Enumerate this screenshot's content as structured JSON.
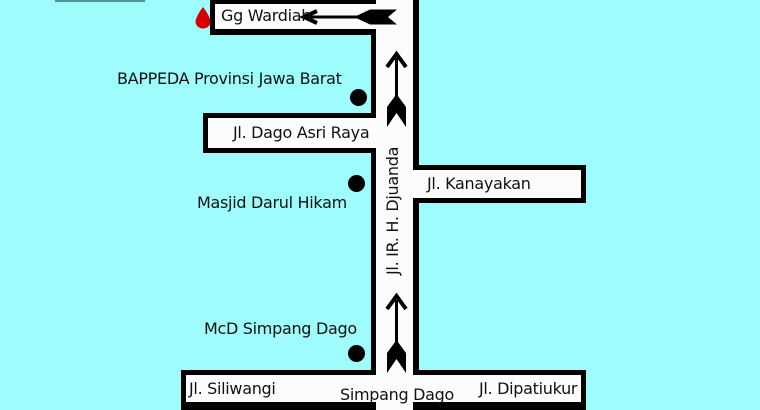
{
  "map": {
    "background_color": "#9ffcfc",
    "road_color": "#fcfcfc",
    "outline_color": "#000000",
    "destination_marker_color": "#d90000",
    "poi_dot_color": "#000000",
    "roads": {
      "djuanda": {
        "label": "Jl. IR. H. Djuanda",
        "orientation": "vertical"
      },
      "gg_wardiah": {
        "label": "Gg Wardiah",
        "orientation": "horizontal"
      },
      "dago_asri": {
        "label": "Jl. Dago Asri Raya",
        "orientation": "horizontal"
      },
      "kanayakan": {
        "label": "Jl. Kanayakan",
        "orientation": "horizontal"
      },
      "siliwangi": {
        "label": "Jl. Siliwangi",
        "orientation": "horizontal"
      },
      "simpang_dago": {
        "label": "Simpang Dago",
        "orientation": "horizontal"
      },
      "dipatiukur": {
        "label": "Jl. Dipatiukur",
        "orientation": "horizontal"
      }
    },
    "places": {
      "bappeda": {
        "label": "BAPPEDA Provinsi Jawa Barat",
        "marker": "black-dot"
      },
      "masjid": {
        "label": "Masjid Darul Hikam",
        "marker": "black-dot"
      },
      "mcd": {
        "label": "McD Simpang Dago",
        "marker": "black-dot"
      }
    },
    "markers": {
      "destination": {
        "icon": "red-drop",
        "near_road": "Gg Wardiah"
      }
    },
    "arrows": [
      {
        "type": "turn-left-arrow",
        "along": "Gg Wardiah"
      },
      {
        "type": "one-way-up-arrow",
        "along": "Jl. IR. H. Djuanda",
        "position": "upper"
      },
      {
        "type": "one-way-up-arrow",
        "along": "Jl. IR. H. Djuanda",
        "position": "lower"
      }
    ]
  }
}
